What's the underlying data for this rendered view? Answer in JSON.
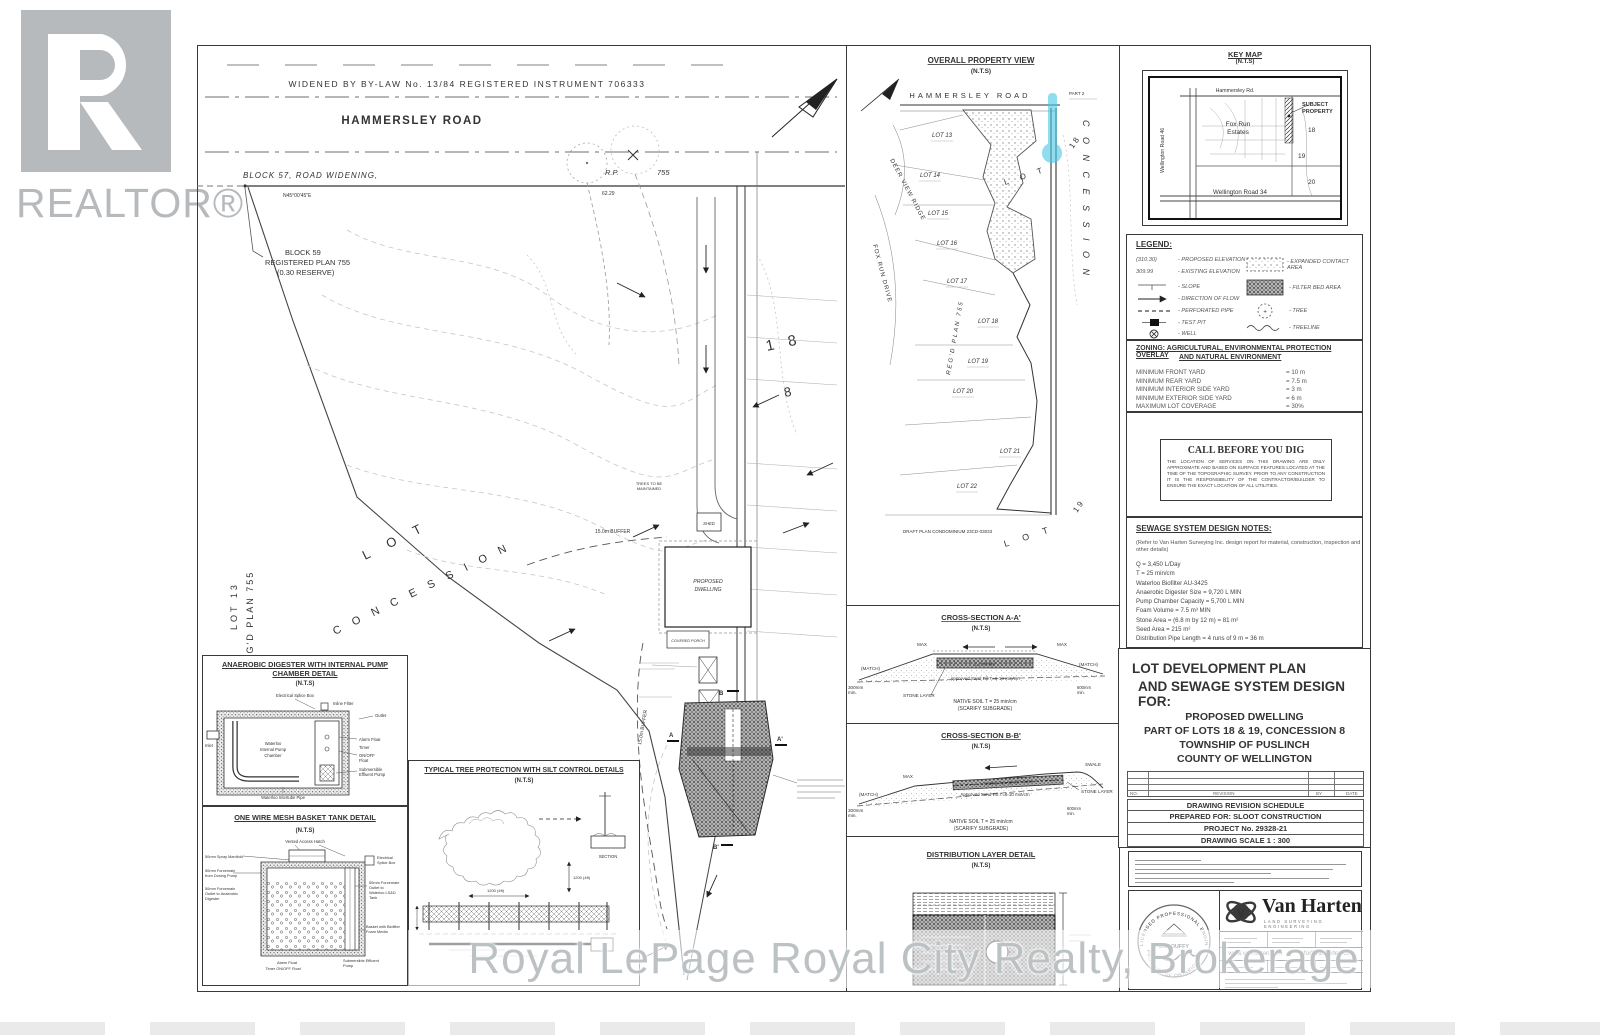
{
  "watermarks": {
    "realtor": "REALTOR®",
    "brokerage": "Royal LePage Royal City Realty, Brokerage"
  },
  "plan": {
    "bylaw": "WIDENED  BY  BY-LAW  No.  13/84      REGISTERED      INSTRUMENT      706333",
    "road": "HAMMERSLEY ROAD",
    "block57": "BLOCK  57,  ROAD  WIDENING,",
    "bearing": "N45°00'45\"E",
    "dist1": "62.29",
    "block59a": "BLOCK 59",
    "block59b": "REGISTERED PLAN 755",
    "block59c": "(0.30 RESERVE)",
    "rp": "R.P.",
    "rp_num": "755",
    "lot13_v": "LOT 13",
    "regd_v": "REG'D PLAN 755",
    "lot_d": "L O T",
    "conc_d": "C O N C E S S I O N",
    "n18": "1 8",
    "n8": "8",
    "buffer1": "15.0m BUFFER",
    "buffer2": "15.0m BUFFER",
    "trees1": "TREES TO BE",
    "trees2": "MAINTAINED",
    "dwelling1": "PROPOSED",
    "dwelling2": "DWELLING",
    "porch": "COVERED PORCH",
    "shed": "SHED",
    "secA": "A",
    "secA2": "A'",
    "secB": "B",
    "secB2": "B'"
  },
  "overall": {
    "title": "OVERALL PROPERTY VIEW",
    "nts": "(N.T.S)",
    "road": "HAMMERSLEY  ROAD",
    "part2": "PART 2",
    "lot13": "LOT 13",
    "lot14": "LOT 14",
    "lot15": "LOT 15",
    "lot16": "LOT 16",
    "lot17": "LOT 17",
    "lot18": "LOT 18",
    "lot19": "LOT 19",
    "lot20": "LOT 20",
    "lot21": "LOT 21",
    "lot22": "LOT 22",
    "deer": "DEER VIEW RIDGE",
    "fox": "FOX RUN DRIVE",
    "regd": "REG'D PLAN 755",
    "lot_mid": "L O T",
    "conc": "C O N C E S S I O N",
    "n18": "1 8",
    "n19": "1 9",
    "lot_bot": "L O T",
    "draft": "DRAFT PLAN CONDOMINIUM 23CD-03033"
  },
  "crossA": {
    "title": "CROSS-SECTION A-A'",
    "nts": "(N.T.S)",
    "match_l": "(MATCH)",
    "match_r": "(MATCH)",
    "max_l": "MAX",
    "max_r": "MAX",
    "mm300": "300mm",
    "mm300b": "min.",
    "w12": "1.2 m max.",
    "sand": "Approved Sand Fill T=6-10 min/cm",
    "stone": "STONE LAYER",
    "mm600": "600mm",
    "mm600b": "min.",
    "native": "NATIVE SOIL T = 25 min/cm",
    "scarify": "(SCARIFY SUBGRADE)"
  },
  "crossB": {
    "title": "CROSS-SECTION B-B'",
    "nts": "(N.T.S)",
    "match": "(MATCH)",
    "max": "MAX",
    "mm300": "300mm",
    "mm300b": "min.",
    "slope": "SLOPE Pipe @ 0.3 - 0.5%",
    "sand": "Approved Sand Fill T=6-10 min/cm",
    "swale": "SWALE",
    "stone": "STONE LAYER",
    "mm600": "600mm",
    "mm600b": "min.",
    "native": "NATIVE SOIL T = 25 min/cm",
    "scarify": "(SCARIFY SUBGRADE)"
  },
  "distribution": {
    "title": "DISTRIBUTION LAYER DETAIL",
    "nts": "(N.T.S)"
  },
  "keymap": {
    "title": "KEY MAP",
    "nts": "(N.T.S)",
    "hammersley": "Hammersley Rd.",
    "wellington46": "Wellington Road 46",
    "fox1": "Fox Run",
    "fox2": "Estates",
    "subject1": "SUBJECT",
    "subject2": "PROPERTY",
    "n18": "18",
    "n19": "19",
    "n20": "20",
    "wellington34": "Wellington Road 34"
  },
  "legend": {
    "title": "LEGEND:",
    "sym_prop": "(310.30)",
    "lab_prop": "- PROPOSED ELEVATION",
    "sym_exist": "309.99",
    "lab_exist": "- EXISTING ELEVATION",
    "lab_slope": "- SLOPE",
    "lab_flow": "- DIRECTION OF FLOW",
    "lab_perf": "- PERFORATED PIPE",
    "lab_test": "- TEST PIT",
    "lab_well": "- WELL",
    "lab_contact": "- EXPANDED CONTACT AREA",
    "lab_filter": "- FILTER BED AREA",
    "lab_tree": "- TREE",
    "lab_treeline": "- TREELINE"
  },
  "zoning": {
    "t1": "ZONING: AGRICULTURAL, ENVIRONMENTAL PROTECTION OVERLAY",
    "t2": "AND NATURAL ENVIRONMENT",
    "r0l": "MINIMUM FRONT YARD",
    "r0v": "= 10 m",
    "r1l": "MINIMUM REAR YARD",
    "r1v": "= 7.5 m",
    "r2l": "MINIMUM INTERIOR SIDE YARD",
    "r2v": "= 3 m",
    "r3l": "MINIMUM EXTERIOR SIDE YARD",
    "r3v": "= 6 m",
    "r4l": "MAXIMUM LOT COVERAGE",
    "r4v": "= 30%"
  },
  "dig": {
    "title": "CALL BEFORE YOU DIG",
    "body": "THE LOCATION OF SERVICES ON THIS DRAWING ARE ONLY APPROXIMATE AND BASED ON SURFACE FEATURES LOCATED AT THE TIME OF THE TOPOGRAPHIC SURVEY.  PRIOR TO ANY CONSTRUCTION IT IS THE RESPONSIBILITY OF THE CONTRACTOR/BUILDER TO ENSURE THE EXACT LOCATION OF ALL UTILITIES."
  },
  "sewage": {
    "title": "SEWAGE SYSTEM DESIGN NOTES:",
    "intro1": "(Refer to Van Harten Surveying Inc. design report for material, construction, inspection and",
    "intro2": "other details)",
    "i0": "Q = 3,450 L/Day",
    "i1": "T = 25 min/cm",
    "i2": "Waterloo Biofilter AU-3425",
    "i3": "Anaerobic Digester Size = 9,720 L MIN",
    "i4": "Pump Chamber Capacity = 5,700 L MIN",
    "i5": "Foam Volume = 7.5 m³ MIN",
    "i6": "Stone Area = (6.8 m by 12 m) = 81 m²",
    "i7": "Seed Area = 215 m²",
    "i8": "Distribution Pipe Length = 4 runs of 9 m = 36 m"
  },
  "titleblock": {
    "h1": "LOT DEVELOPMENT PLAN",
    "h2": "AND SEWAGE SYSTEM DESIGN FOR:",
    "p1": "PROPOSED DWELLING",
    "p2": "PART OF LOTS 18 & 19, CONCESSION 8",
    "p3": "TOWNSHIP OF PUSLINCH",
    "p4": "COUNTY OF WELLINGTON",
    "no": "NO.",
    "rev": "REVISION",
    "by": "BY",
    "date": "DATE",
    "schedule": "DRAWING REVISION SCHEDULE",
    "prepared": "PREPARED FOR: SLOOT CONSTRUCTION",
    "project": "PROJECT No. 29328-21",
    "scale": "DRAWING SCALE 1 : 300"
  },
  "firm": {
    "name": "Van Harten",
    "tagline": "LAND SURVEYING   ENGINEERING",
    "web": "www.vanharten.com",
    "email": "info@vanharten.com",
    "stamp_arc_top": "LICENSED PROFESSIONAL ENGINEER",
    "stamp_arc_bottom": "PROVINCE OF ONTARIO",
    "stamp_name": "J.M. DUFFY"
  },
  "details": {
    "digester": {
      "t1": "ANAEROBIC DIGESTER WITH INTERNAL PUMP",
      "t2": "CHAMBER DETAIL",
      "nts": "(N.T.S)",
      "splice": "Electrical Splice Box",
      "inline": "Inline Filter",
      "outlet": "Outlet",
      "inlet": "Inlet",
      "ch1": "Waterloo",
      "ch2": "Internal Pump",
      "ch3": "Chamber",
      "alarm": "Alarm Float",
      "timer": "Timer",
      "onoff1": "ON/OFF",
      "onoff2": "Float",
      "sub1": "Submersible",
      "sub2": "Effluent Pump",
      "tube": "Waterloo Intertube Pipe"
    },
    "basket": {
      "t1": "ONE WIRE MESH BASKET TANK DETAIL",
      "nts": "(N.T.S)",
      "hatch": "Vented Access Hatch",
      "manifold": "50mm Spray Manifold",
      "fd1": "50mm Forcemain",
      "fd2": "from Dosing Pump",
      "fa1": "50mm Forcemain",
      "fa2": "Outlet to Anaerobic",
      "fa3": "Digester",
      "splice1": "Electrical",
      "splice2": "Splice Box",
      "ft1": "50mm Forcemain",
      "ft2": "Outlet to",
      "ft3": "Waterloo LS&D",
      "ft4": "Tank",
      "bk1": "Basket with Biofilter",
      "bk2": "Foam Media",
      "alarm": "Alarm Float",
      "timer": "Timer ON/OFF Float",
      "sub1": "Submersible Effluent",
      "sub2": "Pump"
    },
    "tree": {
      "t1": "TYPICAL TREE PROTECTION WITH SILT CONTROL DETAILS",
      "nts": "(N.T.S)",
      "dim1": "1200 (4ft)",
      "dim2": "1200 (4ft)",
      "section": "SECTION"
    }
  }
}
